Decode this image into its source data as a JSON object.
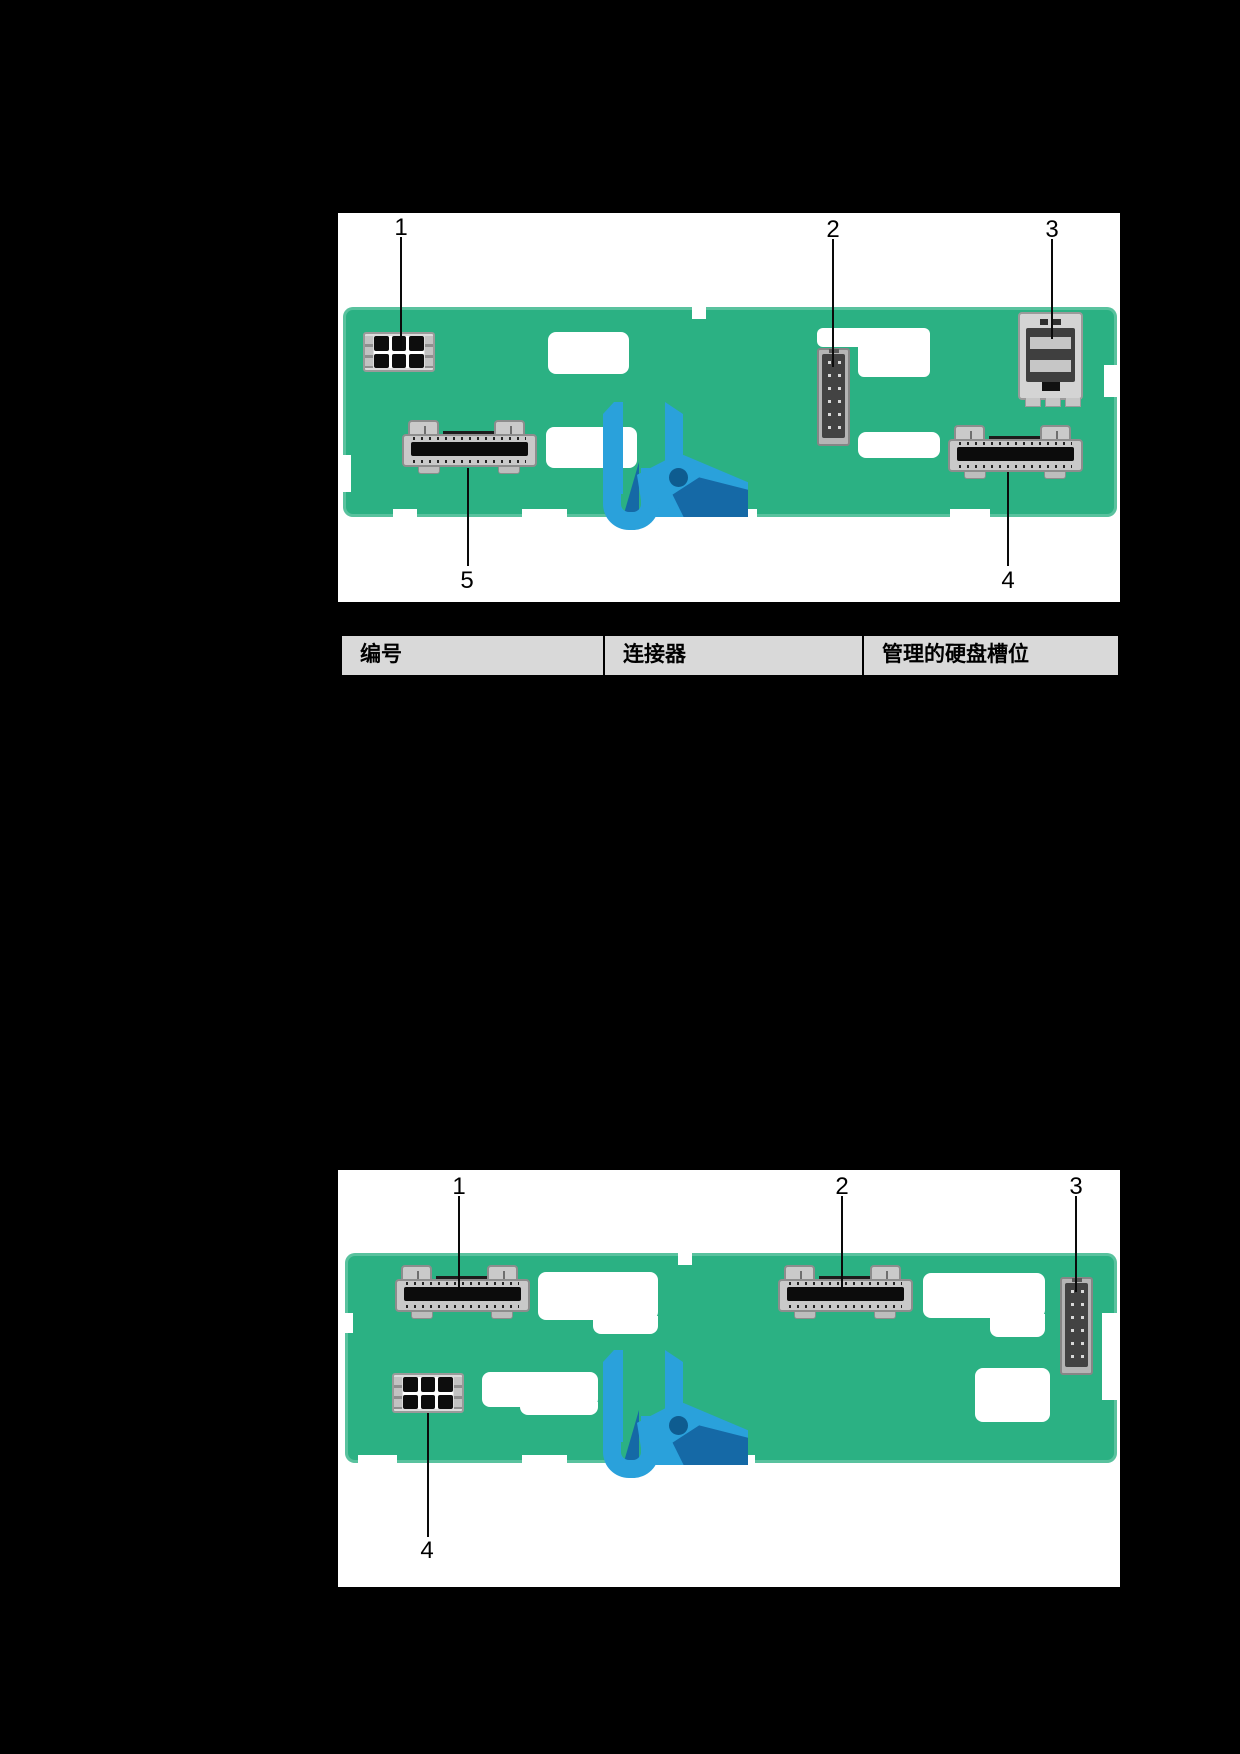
{
  "page": {
    "background": "#000000"
  },
  "colors": {
    "board_green": "#2BB183",
    "latch_blue": "#2AA1DB",
    "latch_blue_dark": "#1569A6",
    "latch_hole_blue": "#0E5C90",
    "connector_gray": "#C9C9C9",
    "connector_dark": "#434343",
    "table_header_bg": "#D9D9D9",
    "figure_bg": "#FFFFFF"
  },
  "figure_top": {
    "callouts": [
      {
        "label": "1"
      },
      {
        "label": "2"
      },
      {
        "label": "3"
      },
      {
        "label": "4"
      },
      {
        "label": "5"
      }
    ]
  },
  "figure_bottom": {
    "callouts": [
      {
        "label": "1"
      },
      {
        "label": "2"
      },
      {
        "label": "3"
      },
      {
        "label": "4"
      }
    ]
  },
  "table": {
    "headers": [
      "编号",
      "连接器",
      "管理的硬盘槽位"
    ]
  }
}
